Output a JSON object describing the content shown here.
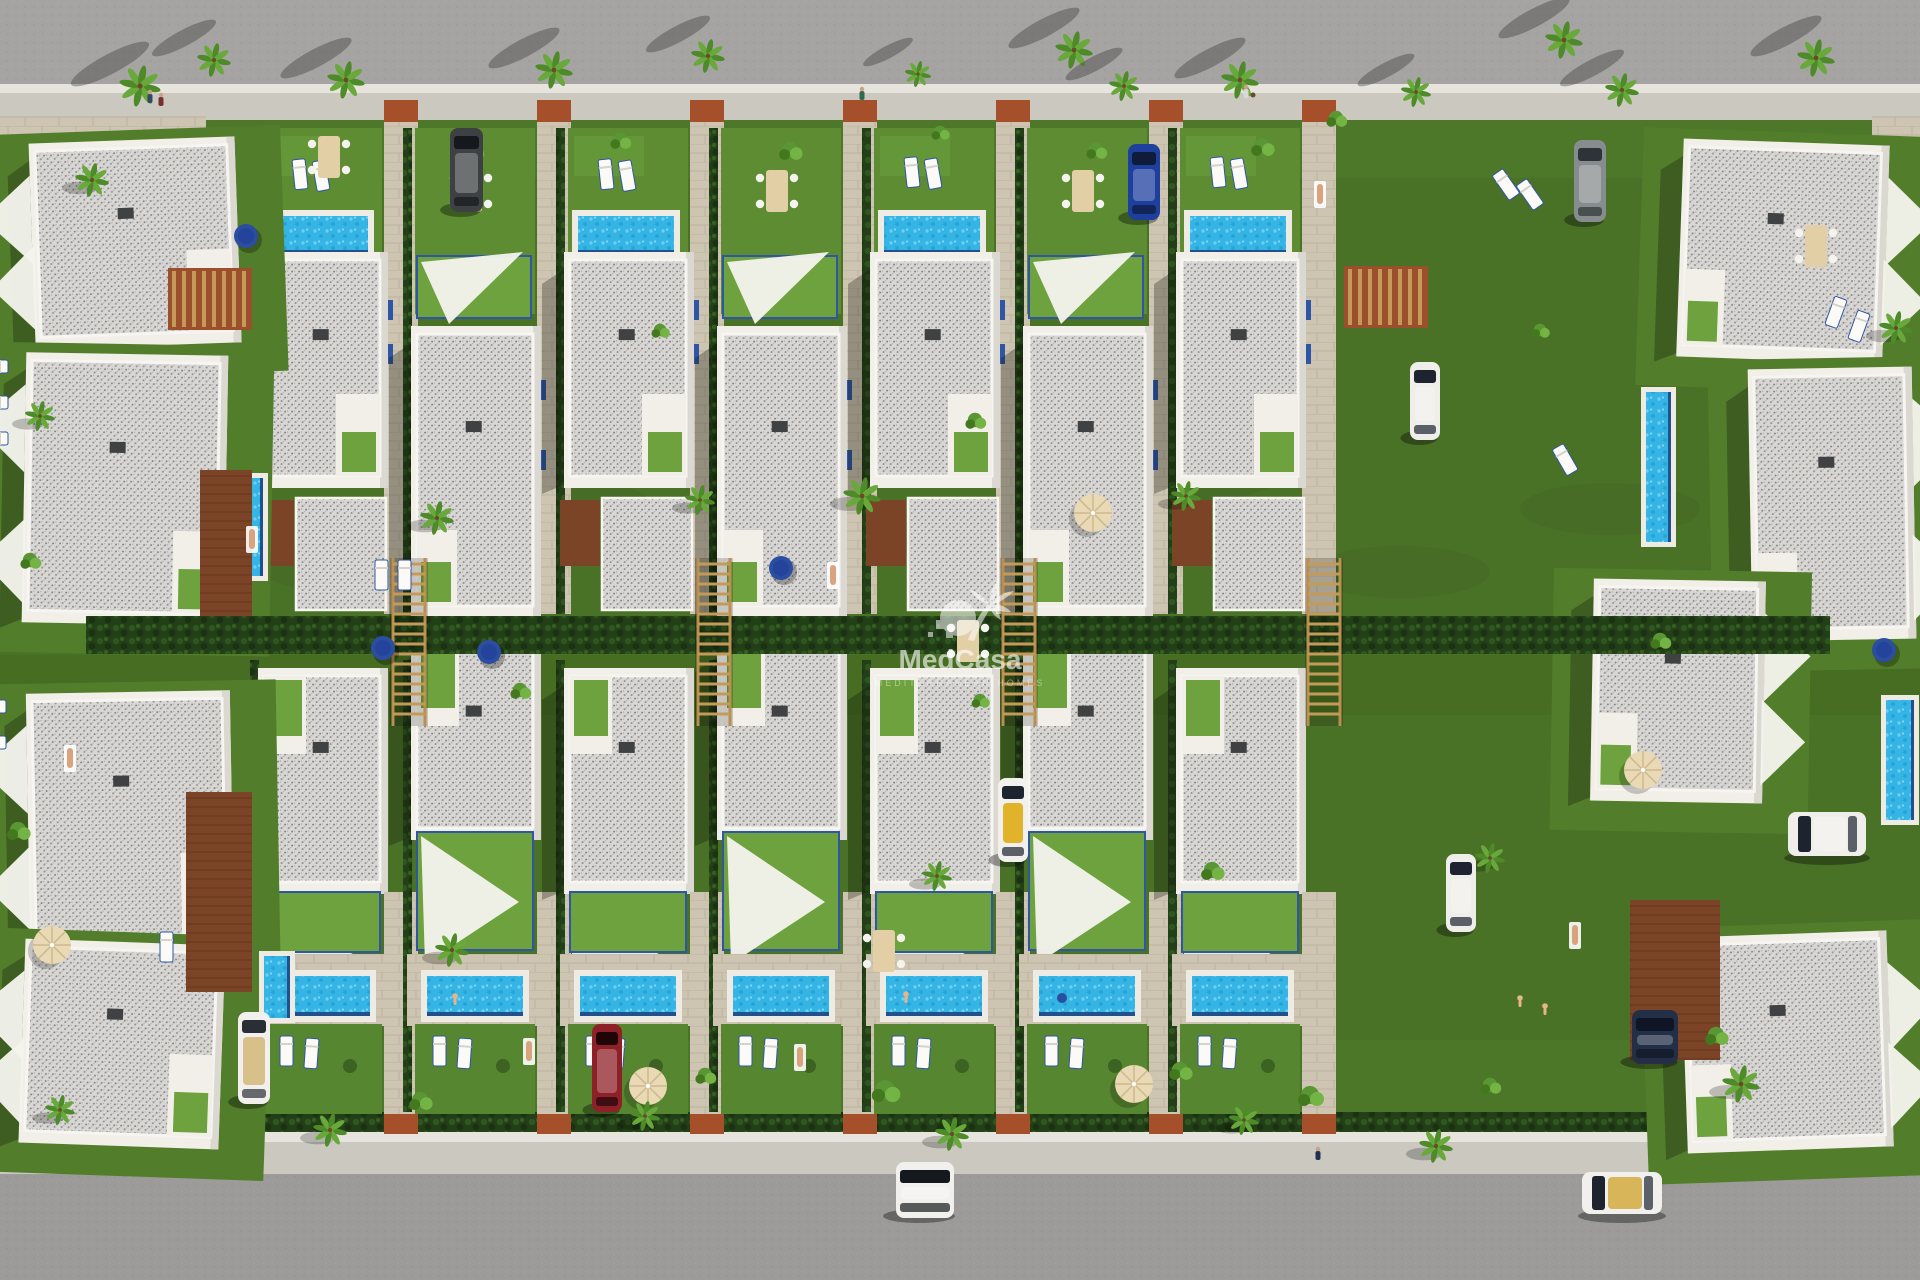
{
  "watermark": {
    "brand": "MedCasa",
    "tagline": "MEDITERRANEAN HOMES",
    "icon": "palm-sun-logo",
    "color": "#ffffff"
  },
  "scene": {
    "type": "aerial-3d-render-residential-development",
    "palette": {
      "asphalt_top": "#a5a4a2",
      "asphalt_bottom": "#9c9b99",
      "sidewalk": "#cbc8c0",
      "curb": "#e6e4dd",
      "grass": "#4a7227",
      "lawn": "#5d8c33",
      "turf": "#6da23e",
      "grass_shade": "#3b5d21",
      "hedge": "#233f18",
      "pavers": "#cdc4b1",
      "terracotta": "#a6502b",
      "deck_brown": "#7c4427",
      "wood": "#c49a58",
      "wall": "#f2efe9",
      "wall_shade": "#dbd8d2",
      "roof": "#d8d7d5",
      "pool_water": "#35b5e5",
      "pool_rim": "#1c3f7e",
      "pool_deck": "#eeebe4",
      "accent_blue": "#2f55a5",
      "sail": "#f4f2ec",
      "shadow": "rgba(15,20,10,0.30)"
    },
    "top_row": {
      "count": 7,
      "x_start": 262,
      "pitch": 153,
      "pool_columns": [
        0,
        2,
        4,
        6
      ]
    },
    "bottom_row": {
      "count": 7,
      "x_start": 262,
      "pitch": 153
    },
    "edge_villas": {
      "left": [
        {
          "x": 38,
          "y": 148,
          "w": 192,
          "h": 186,
          "rot": -2
        },
        {
          "x": 30,
          "y": 362,
          "w": 188,
          "h": 250,
          "rot": 1
        },
        {
          "x": 34,
          "y": 700,
          "w": 190,
          "h": 236,
          "rot": -1
        },
        {
          "x": 28,
          "y": 950,
          "w": 186,
          "h": 184,
          "rot": 2
        }
      ],
      "right": [
        {
          "x": 1686,
          "y": 150,
          "w": 192,
          "h": 198,
          "rot": 2
        },
        {
          "x": 1756,
          "y": 376,
          "w": 150,
          "h": 252,
          "rot": -1
        },
        {
          "x": 1598,
          "y": 588,
          "w": 158,
          "h": 202,
          "rot": 1
        },
        {
          "x": 1690,
          "y": 942,
          "w": 192,
          "h": 196,
          "rot": -2
        }
      ]
    },
    "lap_pools": [
      {
        "x": 238,
        "y": 478,
        "w": 25,
        "h": 98
      },
      {
        "x": 264,
        "y": 956,
        "w": 26,
        "h": 62
      },
      {
        "x": 1646,
        "y": 392,
        "w": 25,
        "h": 150
      },
      {
        "x": 1886,
        "y": 700,
        "w": 28,
        "h": 120
      }
    ],
    "decks": [
      {
        "x": 200,
        "y": 470,
        "w": 52,
        "h": 158
      },
      {
        "x": 186,
        "y": 792,
        "w": 66,
        "h": 200
      },
      {
        "x": 1630,
        "y": 900,
        "w": 90,
        "h": 160
      }
    ],
    "pergola_grids": [
      {
        "x": 168,
        "y": 268,
        "w": 84,
        "h": 62
      },
      {
        "x": 1344,
        "y": 266,
        "w": 84,
        "h": 62
      }
    ],
    "ladders": [
      {
        "x": 390
      },
      {
        "x": 695
      },
      {
        "x": 1000
      },
      {
        "x": 1305
      }
    ],
    "cars": [
      {
        "label": "dark-suv",
        "x": 450,
        "y": 128,
        "w": 33,
        "h": 84,
        "body": "#3d4143",
        "glass": "#15191d",
        "orient": "v"
      },
      {
        "label": "blue-car",
        "x": 1128,
        "y": 144,
        "w": 32,
        "h": 76,
        "body": "#1d3f9e",
        "glass": "#101b3a",
        "orient": "v"
      },
      {
        "label": "silver-car",
        "x": 1574,
        "y": 140,
        "w": 32,
        "h": 82,
        "body": "#878c8e",
        "glass": "#2d3438",
        "orient": "v"
      },
      {
        "label": "white-suv",
        "x": 1410,
        "y": 362,
        "w": 30,
        "h": 78,
        "body": "#efeeea",
        "glass": "#1d2430",
        "orient": "v"
      },
      {
        "label": "taxi-cabrio",
        "x": 998,
        "y": 778,
        "w": 30,
        "h": 84,
        "body": "#f1f0ed",
        "glass": "#1d2430",
        "interior": "#e0b32b",
        "orient": "v"
      },
      {
        "label": "white-car",
        "x": 1446,
        "y": 854,
        "w": 30,
        "h": 78,
        "body": "#efeeea",
        "glass": "#1d2430",
        "orient": "v"
      },
      {
        "label": "white-suv-2",
        "x": 1788,
        "y": 812,
        "w": 78,
        "h": 44,
        "body": "#efeeea",
        "glass": "#1d2430",
        "orient": "h"
      },
      {
        "label": "dark-car",
        "x": 1632,
        "y": 1010,
        "w": 46,
        "h": 54,
        "body": "#232f47",
        "glass": "#0f1524",
        "orient": "v"
      },
      {
        "label": "red-car",
        "x": 592,
        "y": 1024,
        "w": 30,
        "h": 88,
        "body": "#8e2028",
        "glass": "#200508",
        "orient": "v"
      },
      {
        "label": "white-sports-car",
        "x": 238,
        "y": 1012,
        "w": 32,
        "h": 92,
        "body": "#f1f0ed",
        "interior": "#d8c08a",
        "glass": "#2a2f36",
        "orient": "v"
      },
      {
        "label": "white-van",
        "x": 896,
        "y": 1162,
        "w": 58,
        "h": 56,
        "body": "#f1f0ed",
        "glass": "#15191d",
        "orient": "v"
      },
      {
        "label": "white-cabrio",
        "x": 1582,
        "y": 1172,
        "w": 80,
        "h": 42,
        "body": "#f1f0ed",
        "interior": "#d8b559",
        "glass": "#1d2430",
        "orient": "h"
      }
    ],
    "palms": [
      [
        140,
        86,
        1.1
      ],
      [
        214,
        60,
        0.9
      ],
      [
        346,
        80,
        1.0
      ],
      [
        554,
        70,
        1.0
      ],
      [
        708,
        56,
        0.9
      ],
      [
        918,
        74,
        0.7
      ],
      [
        1074,
        50,
        1.0
      ],
      [
        1124,
        86,
        0.8
      ],
      [
        1240,
        80,
        1.0
      ],
      [
        1416,
        92,
        0.8
      ],
      [
        1564,
        40,
        1.0
      ],
      [
        1622,
        90,
        0.9
      ],
      [
        1816,
        58,
        1.0
      ],
      [
        92,
        180,
        0.9
      ],
      [
        40,
        416,
        0.8
      ],
      [
        437,
        518,
        0.9
      ],
      [
        700,
        500,
        0.8
      ],
      [
        862,
        496,
        1.0
      ],
      [
        1186,
        496,
        0.8
      ],
      [
        1896,
        328,
        0.9
      ],
      [
        452,
        950,
        0.9
      ],
      [
        937,
        876,
        0.8
      ],
      [
        1490,
        858,
        0.8
      ],
      [
        330,
        1130,
        0.9
      ],
      [
        645,
        1116,
        0.8
      ],
      [
        952,
        1134,
        0.9
      ],
      [
        1244,
        1120,
        0.8
      ],
      [
        1436,
        1146,
        0.9
      ],
      [
        1741,
        1084,
        1.0
      ],
      [
        60,
        1110,
        0.8
      ]
    ],
    "shrubs": [
      [
        470,
        150,
        1.0
      ],
      [
        620,
        140,
        0.8
      ],
      [
        790,
        150,
        0.9
      ],
      [
        940,
        132,
        0.7
      ],
      [
        1096,
        150,
        0.8
      ],
      [
        1262,
        146,
        0.9
      ],
      [
        1336,
        118,
        0.8
      ],
      [
        660,
        330,
        0.7
      ],
      [
        975,
        420,
        0.8
      ],
      [
        1540,
        330,
        0.7
      ],
      [
        30,
        560,
        0.8
      ],
      [
        18,
        830,
        0.9
      ],
      [
        520,
        690,
        0.8
      ],
      [
        980,
        700,
        0.7
      ],
      [
        1212,
        870,
        0.9
      ],
      [
        1660,
        640,
        0.8
      ],
      [
        420,
        1100,
        0.9
      ],
      [
        705,
        1075,
        0.8
      ],
      [
        885,
        1090,
        1.1
      ],
      [
        1180,
        1070,
        0.9
      ],
      [
        1310,
        1095,
        1.0
      ],
      [
        1490,
        1085,
        0.8
      ],
      [
        1716,
        1035,
        0.9
      ]
    ],
    "people_walking": [
      [
        150,
        95
      ],
      [
        161,
        98
      ],
      [
        862,
        92
      ],
      [
        1246,
        90
      ],
      [
        1318,
        1152
      ]
    ],
    "sunbathers": [
      [
        70,
        757
      ],
      [
        833,
        574
      ],
      [
        1320,
        193
      ],
      [
        529,
        1050
      ],
      [
        800,
        1056
      ],
      [
        1575,
        934
      ],
      [
        252,
        538
      ]
    ],
    "swimmers": [
      [
        455,
        996
      ],
      [
        906,
        994
      ],
      [
        1520,
        998
      ],
      [
        1545,
        1006
      ]
    ],
    "floats": [
      [
        1062,
        998
      ]
    ],
    "umbrellas": [
      [
        648,
        1086
      ],
      [
        1134,
        1084
      ],
      [
        52,
        945
      ],
      [
        1093,
        513
      ],
      [
        1643,
        770
      ]
    ],
    "daybeds": [
      [
        246,
        236
      ],
      [
        383,
        648
      ],
      [
        489,
        652
      ],
      [
        1884,
        650
      ],
      [
        781,
        568
      ]
    ],
    "dining_sets": [
      [
        460,
        170
      ],
      [
        766,
        170
      ],
      [
        1072,
        170
      ],
      [
        318,
        136
      ],
      [
        957,
        620
      ],
      [
        1805,
        225
      ],
      [
        873,
        930
      ]
    ],
    "loungers": [
      [
        292,
        160,
        -6
      ],
      [
        312,
        162,
        -10
      ],
      [
        598,
        160,
        -6
      ],
      [
        618,
        162,
        -10
      ],
      [
        904,
        158,
        -6
      ],
      [
        924,
        160,
        -10
      ],
      [
        1210,
        158,
        -6
      ],
      [
        1230,
        160,
        -10
      ],
      [
        1492,
        176,
        -35
      ],
      [
        1516,
        186,
        -35
      ],
      [
        375,
        560,
        0
      ],
      [
        398,
        560,
        0
      ],
      [
        1552,
        450,
        -30
      ],
      [
        8,
        360,
        90
      ],
      [
        8,
        396,
        90
      ],
      [
        8,
        432,
        90
      ],
      [
        6,
        700,
        90
      ],
      [
        6,
        736,
        90
      ],
      [
        1835,
        296,
        20
      ],
      [
        1858,
        310,
        20
      ],
      [
        160,
        932,
        0
      ]
    ]
  }
}
